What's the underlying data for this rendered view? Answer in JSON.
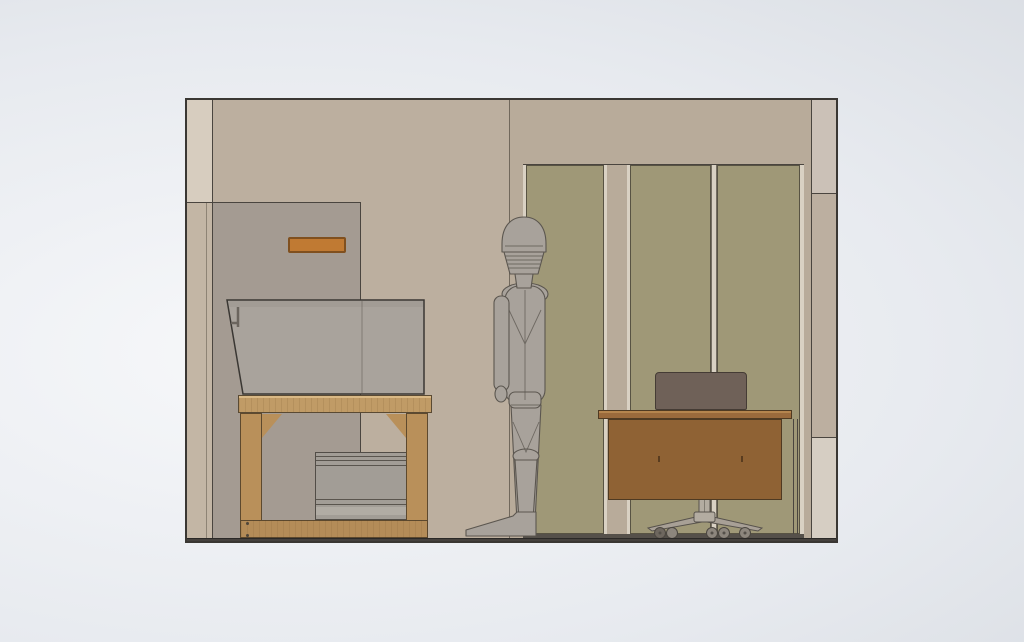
{
  "app": {
    "name": "cad-viewport",
    "description": "3D CAD shaded elevation render of a room interior with workbench, mannequin, desk and office chair"
  },
  "colors": {
    "bg-light": "#f7f8fa",
    "bg-mid": "#e7eaef",
    "bg-dark": "#d6dae0",
    "outline": "#3a3733",
    "line-dark": "#4a453f",
    "wall": "#bcaf9f",
    "strip-top": "#d7cdbf",
    "strip-bottom": "#c3b6a5",
    "partition": "#a49b92",
    "vent": "#c07a33",
    "vent-border": "#80501f",
    "olive": "#9f9877",
    "divider": "#d9d1c3",
    "col-top": "#cbc1b7",
    "col-mid": "#bcafa0",
    "col-bottom": "#d6cec3",
    "enclosure": "#a9a39c",
    "machine": "#a29d96",
    "machine-light": "#b1aca4",
    "wood": "#b9905a",
    "wood-top": "#c09b66",
    "wood-rail": "#b48c58",
    "wood-light": "#dab985",
    "desk": "#8f6234",
    "desk-top": "#9a6a3c",
    "desk-edge": "#b5854e",
    "box": "#6f6158",
    "chair-metal": "#a8a096",
    "chair-cyl": "#b3aca1",
    "wheel-dark": "#6e675f",
    "wheel-mid": "#8d867d",
    "mannequin": "#a8a29b",
    "mannequin-line": "#5b564f",
    "floor": "#45413d",
    "floor-line": "#2b2927"
  },
  "objects": {
    "viewport": {
      "label": "3D CAD viewport"
    },
    "room": {
      "label": "Room elevation"
    },
    "left_column": {
      "label": "Left wall column strip"
    },
    "partition": {
      "label": "Gray partition panel"
    },
    "vent": {
      "label": "Orange wall vent"
    },
    "workbench": {
      "label": "Wood workbench with gray enclosure hood"
    },
    "machine": {
      "label": "Equipment unit under workbench"
    },
    "mannequin": {
      "label": "Humanoid mannequin figure"
    },
    "panels": {
      "label": "Olive wall panels"
    },
    "right_column": {
      "label": "Right wall column strip"
    },
    "desk": {
      "label": "Brown office desk"
    },
    "desk_box": {
      "label": "Dark case on desk"
    },
    "chair": {
      "label": "Office chair base with casters"
    },
    "floor": {
      "label": "Floor line"
    }
  }
}
